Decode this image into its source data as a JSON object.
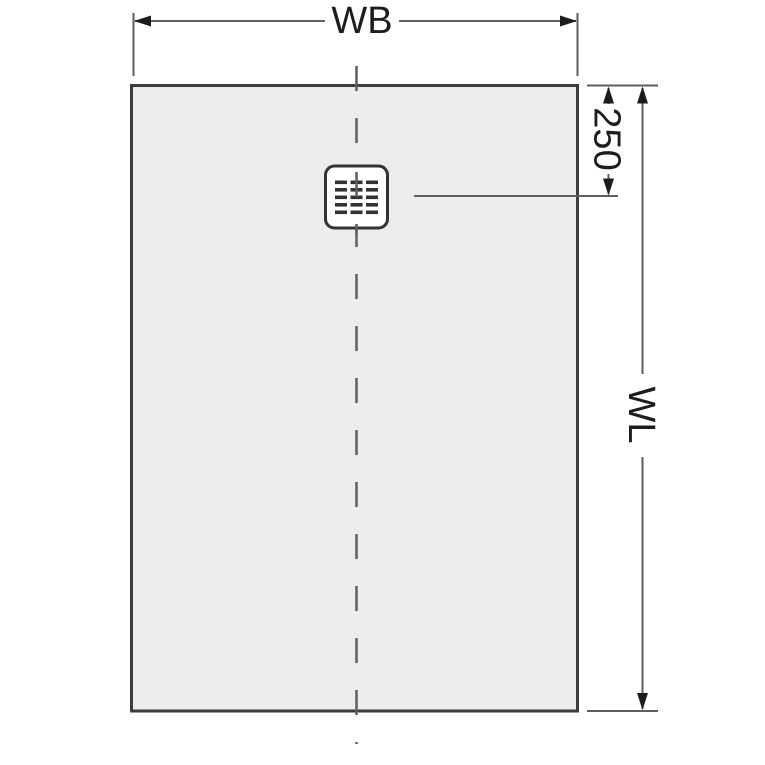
{
  "colors": {
    "background": "#ffffff",
    "tray_fill": "#ececec",
    "tray_border": "#3c3c3c",
    "line": "#5e5e5e",
    "arrow": "#1c1c1c",
    "text": "#1d1d1d",
    "drain_border": "#333333"
  },
  "diagram": {
    "labels": {
      "width": "WB",
      "length": "WL",
      "drain_offset": "250"
    },
    "icons": {
      "drain": "square-grate-with-slots"
    }
  }
}
